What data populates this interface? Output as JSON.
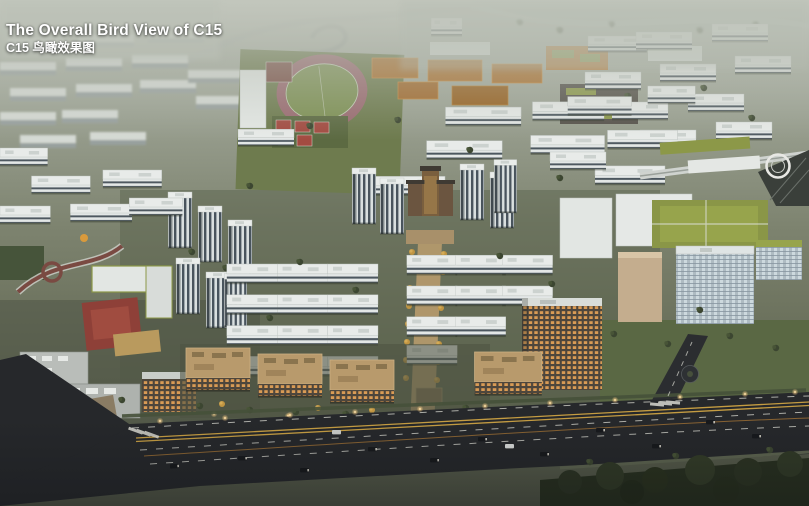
{
  "overlay": {
    "title_en": "The Overall Bird View of C15",
    "title_zh": "C15 鸟瞰效果图"
  },
  "scene": {
    "kind": "architectural aerial rendering at dusk",
    "landmarks": [
      "hazy-distant-skyline",
      "curved-highway-ramp",
      "river-wetland",
      "school-running-track",
      "sports-courts",
      "orange-roof-school-buildings",
      "white-residential-slab-grid",
      "highrise-tower-cluster",
      "central-gate-landmark",
      "golden-tree-lined-axis",
      "office-campus-green-roofs",
      "elevated-rail-circular-footbridge",
      "kindergarten-red-courtyard",
      "curved-park-walkway",
      "lit-commercial-street-blocks",
      "main-boulevard-with-traffic",
      "roadside-tree-canopy"
    ],
    "palette": {
      "fog": "#b8bdb3",
      "building_white": "#e8ebe9",
      "window_dark": "#4c575f",
      "track_red": "#9a6a70",
      "field_green": "#7e9154",
      "court_red": "#a34b41",
      "roof_orange": "#ab6f2d",
      "green_roof": "#8c9848",
      "glass_blue": "#aebbc2",
      "road_asphalt": "#26282b",
      "lane_yellow": "#c49c42",
      "tree_dark": "#3c4631",
      "tree_gold": "#c09542",
      "lit_window": "#d99b55",
      "axis_paving": "#b59a6d"
    }
  }
}
